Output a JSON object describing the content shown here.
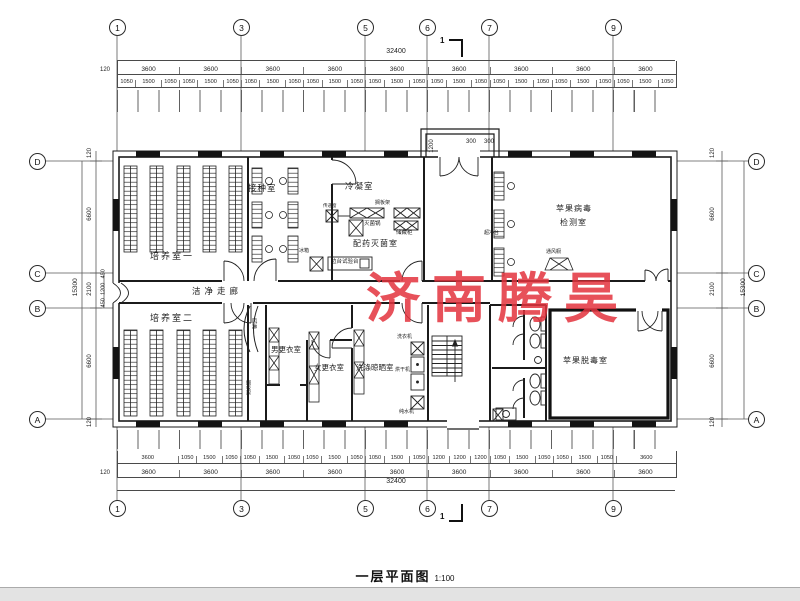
{
  "watermark": "济南腾昊",
  "title": {
    "text": "一层平面图",
    "scale": "1:100"
  },
  "section": {
    "top": "1",
    "bottom": "1"
  },
  "axes": {
    "top": [
      "1",
      "3",
      "5",
      "6",
      "7",
      "9"
    ],
    "bottom": [
      "1",
      "3",
      "5",
      "6",
      "7",
      "9"
    ],
    "left": [
      "D",
      "C",
      "B",
      "A"
    ],
    "right": [
      "D",
      "C",
      "B",
      "A"
    ]
  },
  "dims": {
    "top": {
      "total": "32400",
      "edge": "120",
      "bays": [
        "3600",
        "3600",
        "3600",
        "3600",
        "3600",
        "3600",
        "3600",
        "3600",
        "3600"
      ],
      "sub": [
        "1050",
        "1500",
        "1050",
        "1050",
        "1500",
        "1050",
        "1050",
        "1500",
        "1050",
        "1050",
        "1500",
        "1050",
        "1050",
        "1500",
        "1050",
        "1050",
        "1500",
        "1050",
        "1050",
        "1500",
        "1050",
        "1050",
        "1500",
        "1050",
        "1050",
        "1500",
        "1050"
      ]
    },
    "bottom": {
      "total": "32400",
      "edge": "120",
      "bays": [
        "3600",
        "3600",
        "3600",
        "3600",
        "3600",
        "3600",
        "3600",
        "3600",
        "3600"
      ],
      "sub": [
        "3600",
        "1050",
        "1500",
        "1050",
        "1050",
        "1500",
        "1050",
        "1050",
        "1500",
        "1050",
        "1050",
        "1500",
        "1050",
        "1200",
        "1200",
        "1200",
        "1050",
        "1500",
        "1050",
        "1050",
        "1500",
        "1050",
        "3600"
      ]
    },
    "left": {
      "total": "15300",
      "outer": [
        "120",
        "6600",
        "2100",
        "6600",
        "120"
      ],
      "inner": [
        "450",
        "1200",
        "450"
      ]
    },
    "right": {
      "total": "15300",
      "outer": [
        "120",
        "6600",
        "2100",
        "6600",
        "120"
      ]
    },
    "porch": {
      "depth": "1200",
      "a": "300",
      "b": "300"
    }
  },
  "rooms": {
    "culture1": "培养室一",
    "inoculation": "接种室",
    "cooling": "冷凝室",
    "prep": "配药灭菌室",
    "detect_line1": "苹果病毒",
    "detect_line2": "检测室",
    "corridor": "洁净走廊",
    "culture2": "培养室二",
    "men": "男更衣室",
    "women": "女更衣室",
    "washing": "洗涤晾晒室",
    "detox": "苹果脱毒室"
  },
  "fixtures": {
    "shelf": "搁板架",
    "sterilizer": "灭菌锅",
    "cabinet": "储藏柜",
    "bench": "边台试验台",
    "pass": "传递窗",
    "fridge": "冰箱",
    "cleanbench": "超净台",
    "fume": "通风橱",
    "airshower": "风淋",
    "shelf2": "搁板架",
    "washer": "洗衣机",
    "dryer": "烘干机",
    "purifier": "纯水机"
  }
}
